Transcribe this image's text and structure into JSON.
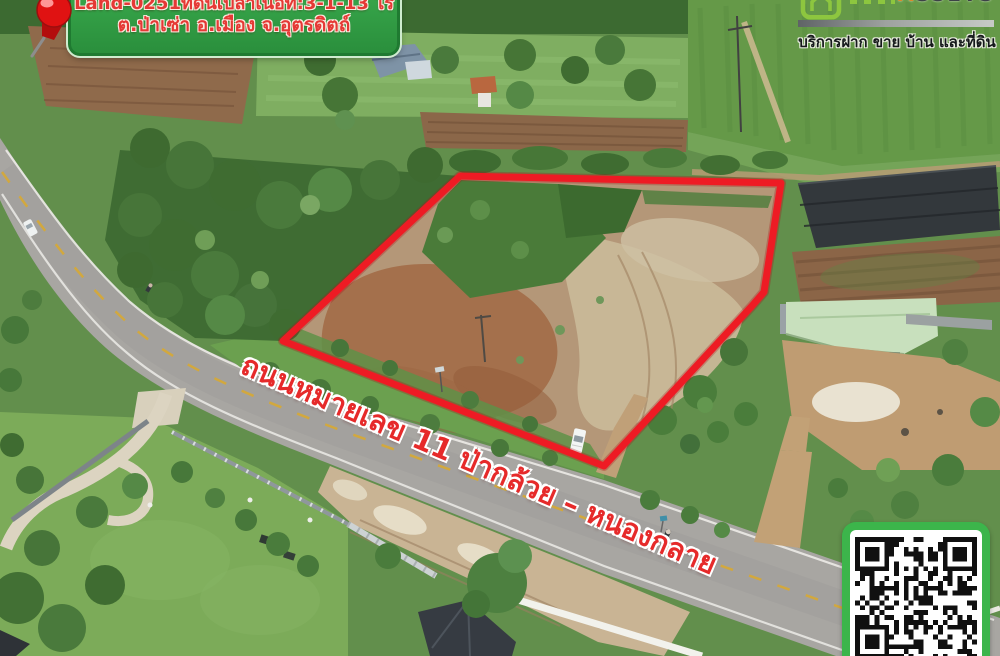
{
  "banner": {
    "pin_icon": "pushpin-icon",
    "line1": "Land-0251ที่ดินเปล่าเนื้อที่:3-1-13 ไร่",
    "line2": "ต.ป่าเซ่า อ.เมือง จ.อุตรดิตถ์",
    "bg_color": "#2f9a42",
    "text_color": "#e53935"
  },
  "logo": {
    "house_icon": "house-icon",
    "brand_first": "A",
    "brand_rest": "SSETS",
    "brand_first_color": "#d98a2b",
    "tagline": "บริการฝาก ขาย บ้าน และที่ดิน",
    "green": "#8dc63f"
  },
  "road_label": {
    "text": "ถนนหมายเลข 11 ป่ากล้วย – หนองกลาย",
    "color": "#e62a2a"
  },
  "plot_boundary": {
    "color": "#ee1b24"
  },
  "qr": {
    "icon": "qr-code",
    "frame_color": "#3cb54b"
  }
}
